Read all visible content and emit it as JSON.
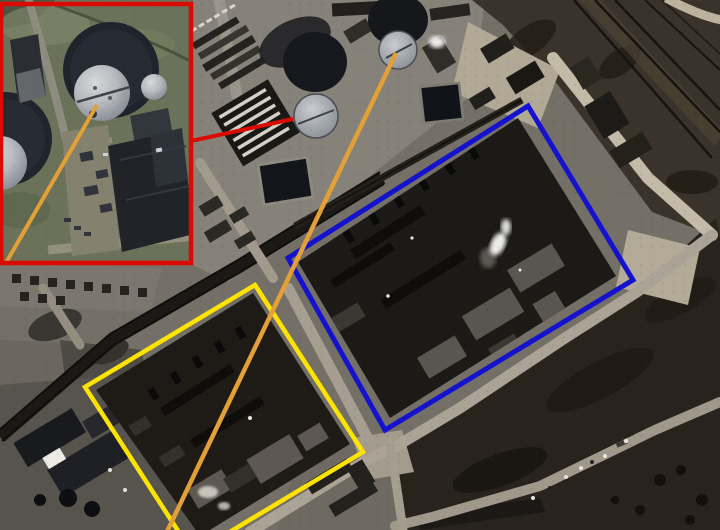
{
  "canvas": {
    "width": 720,
    "height": 530
  },
  "scene": {
    "kind": "satellite-photo-with-annotations"
  },
  "colors": {
    "annotation_red": "#da0b02",
    "annotation_blue": "#1512cd",
    "annotation_yellow": "#fce303",
    "annotation_orange": "#e2a036"
  },
  "annotations": {
    "inset_frame": {
      "color": "#da0b02",
      "stroke_width": 4.5,
      "points": "1,4 191,4 191,263 1,263"
    },
    "inset_pointer_line": {
      "color": "#da0b02",
      "stroke_width": 4,
      "x1": 191,
      "y1": 141,
      "x2": 293,
      "y2": 119
    },
    "blue_box": {
      "color": "#1512cd",
      "stroke_width": 5,
      "points": "528,106 633,280 385,430 288,258"
    },
    "yellow_box": {
      "color": "#fce303",
      "stroke_width": 4.5,
      "points": "255,285 363,452 193,554 85,387"
    },
    "orange_line_main": {
      "color": "#e2a036",
      "stroke_width": 4.5,
      "x1": 396,
      "y1": 53,
      "x2": 163,
      "y2": 540
    },
    "orange_line_inset": {
      "color": "#e2a036",
      "stroke_width": 4,
      "x1": 97,
      "y1": 105,
      "x2": 3,
      "y2": 268
    }
  }
}
